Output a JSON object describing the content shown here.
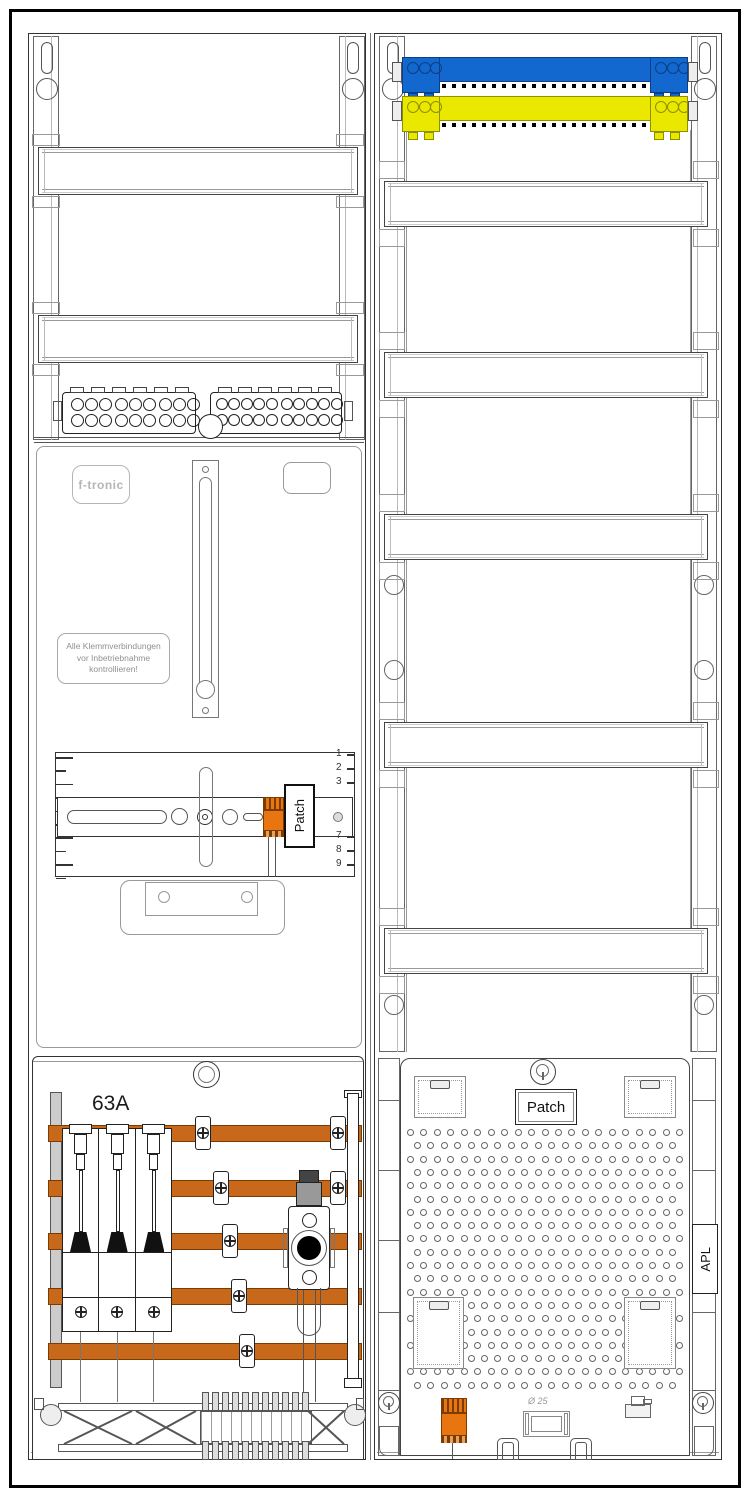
{
  "colors": {
    "busbar_blue": "#1268cf",
    "busbar_yellow": "#ebe800",
    "copper": "#c8681a",
    "component_orange": "#e8750f"
  },
  "left_column": {
    "brand_label": "f-tronic",
    "warning_label_lines": [
      "Alle Klemmverbindungen",
      "vor Inbetriebnahme",
      "kontrollieren!"
    ],
    "fuse_rating_label": "63A",
    "patch_label": "Patch",
    "ruler_numbers": [
      "1",
      "2",
      "3",
      "7",
      "8",
      "9"
    ]
  },
  "right_column": {
    "patch_label": "Patch",
    "apl_label": "APL",
    "knockout_diameter_label": "Ø 25",
    "perforated_plate": {
      "hole_rows": 20,
      "hole_cols": 21
    }
  }
}
